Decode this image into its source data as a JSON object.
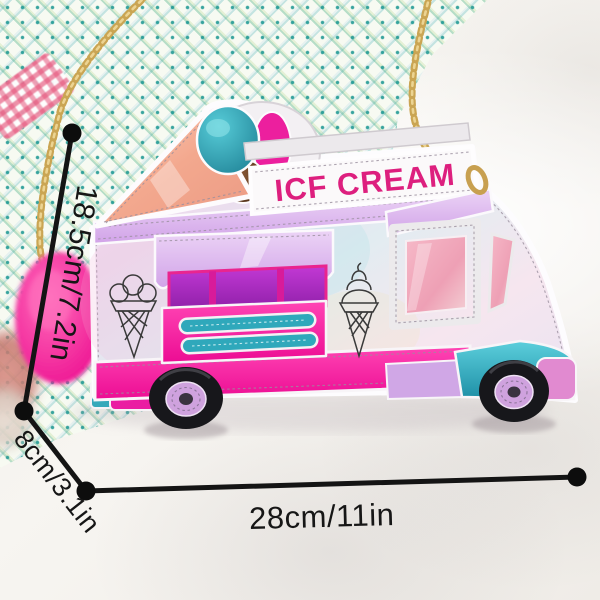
{
  "product": {
    "sign_text": "ICF CREAM"
  },
  "dimensions": {
    "height": "18.5cm/7.2in",
    "depth": "8cm/3.1in",
    "width": "28cm/11in"
  },
  "colors": {
    "hot_pink": "#ef109a",
    "sign_magenta": "#dd1f7e",
    "lavender": "#d9b3ea",
    "purple_window": "#a224bc",
    "teal": "#2fa8bb",
    "peach_cone": "#f4ab92",
    "gold_chain": "#c9a558",
    "pom_pom": "#f2109b",
    "dimension_line": "#141414"
  }
}
